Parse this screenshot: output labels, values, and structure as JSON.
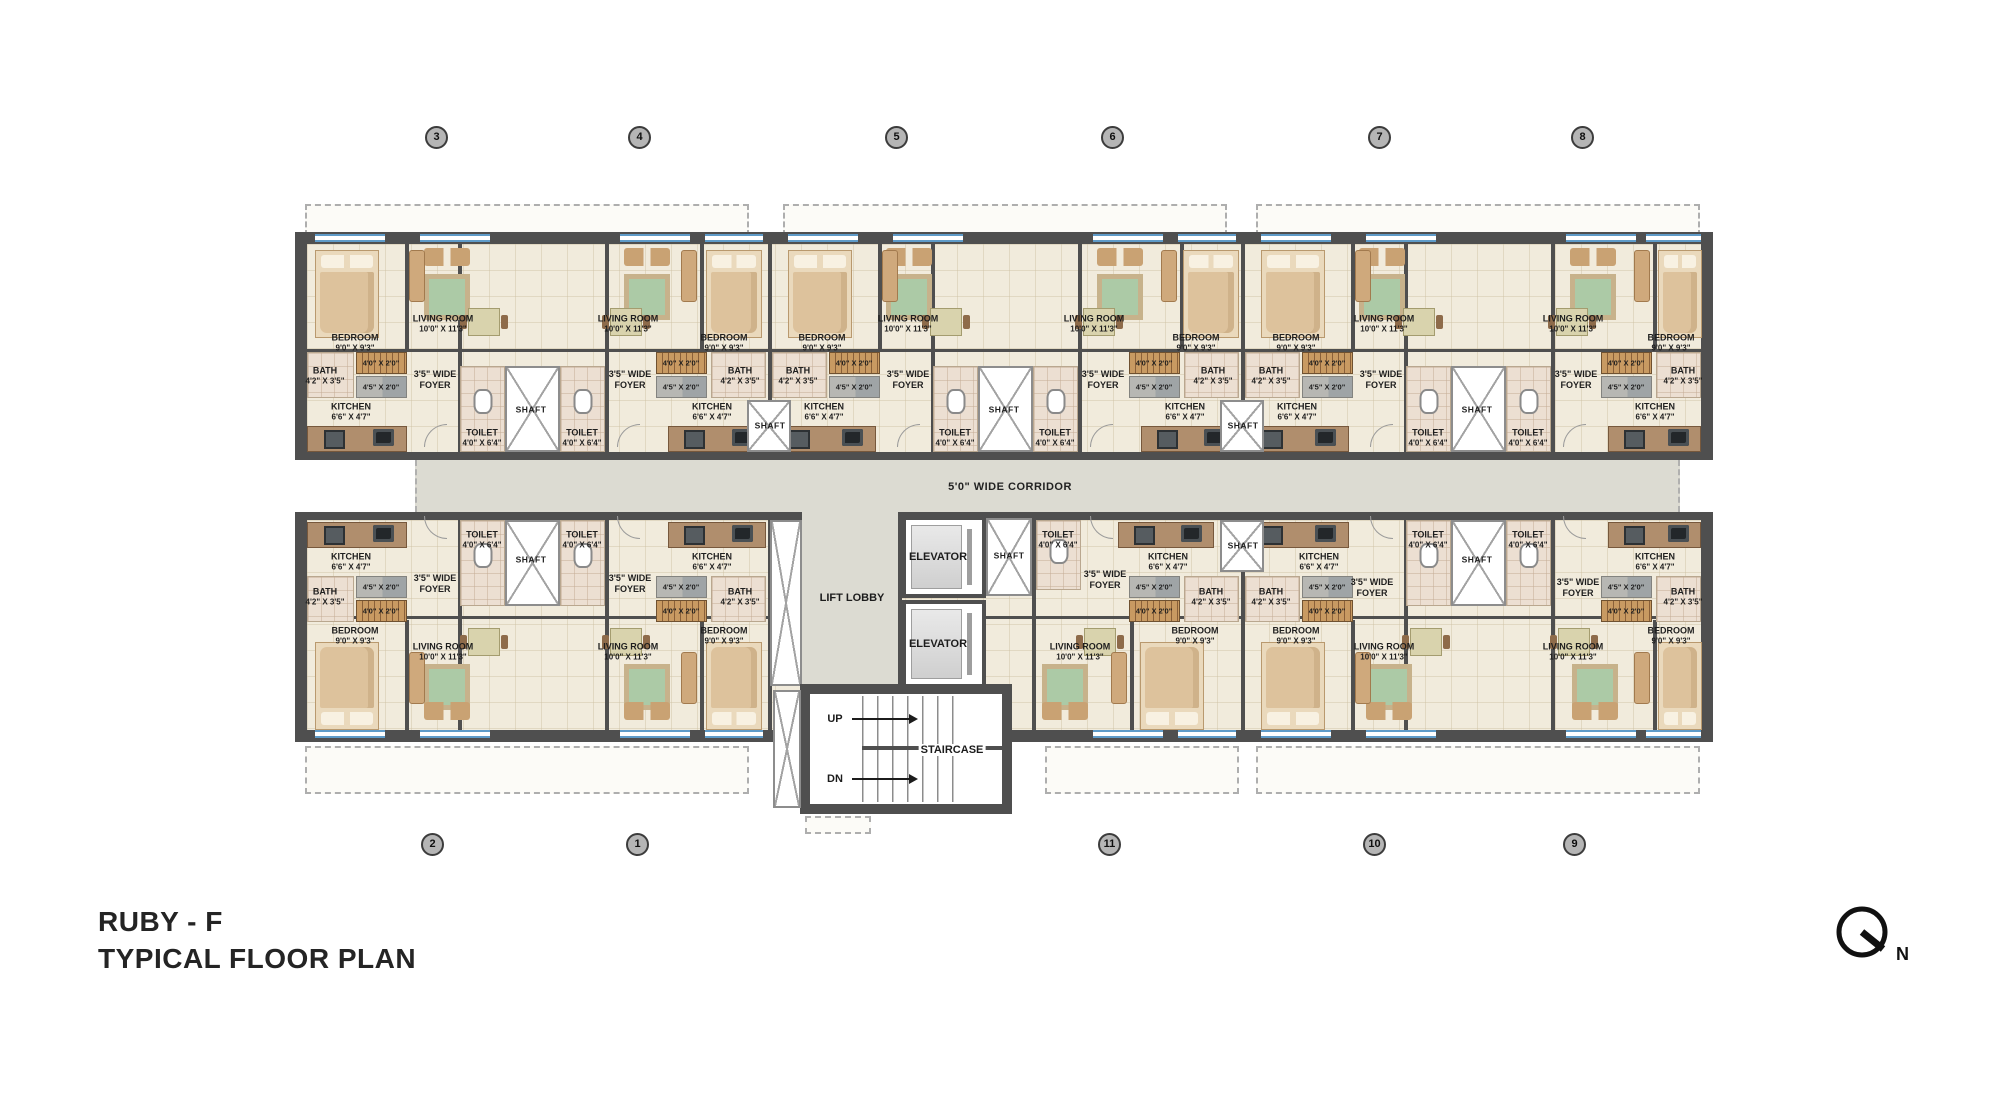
{
  "title": {
    "line1": "RUBY - F",
    "line2": "TYPICAL FLOOR PLAN"
  },
  "north": {
    "label": "N"
  },
  "corridor": {
    "label": "5'0\" WIDE CORRIDOR"
  },
  "grid_markers": {
    "top": [
      "3",
      "4",
      "5",
      "6",
      "7",
      "8"
    ],
    "bottom": [
      "2",
      "1",
      "11",
      "10",
      "9"
    ]
  },
  "rooms": {
    "bedroom": {
      "name": "BEDROOM",
      "dim": "9'0\" X 9'3\""
    },
    "living": {
      "name": "LIVING ROOM",
      "dim": "10'0\" X 11'3\""
    },
    "kitchen": {
      "name": "KITCHEN",
      "dim": "6'6\" X 4'7\""
    },
    "bath": {
      "name": "BATH",
      "dim": "4'2\" X 3'5\""
    },
    "toilet": {
      "name": "TOILET",
      "dim": "4'0\" X 6'4\""
    },
    "foyer": {
      "line1": "3'5\" WIDE",
      "line2": "FOYER"
    },
    "shaft": {
      "name": "SHAFT"
    },
    "wardrobe_dim": "4'0\" X 2'0\"",
    "platform_dim": "4'5\" X 2'0\""
  },
  "core": {
    "lift_lobby": "LIFT LOBBY",
    "elevator": "ELEVATOR",
    "staircase": "STAIRCASE",
    "up": "UP",
    "dn": "DN"
  },
  "colors": {
    "wall": "#4f4f4f",
    "floor": "#f1ebdc",
    "bath_floor": "#ecdfd2",
    "corridor": "#dcdbd2",
    "counter": "#b08e6d",
    "wood": "#c9a273",
    "rug_green": "#accaa6",
    "window_blue": "#5f9bc8",
    "grid_circle": "#b5b5b5"
  }
}
